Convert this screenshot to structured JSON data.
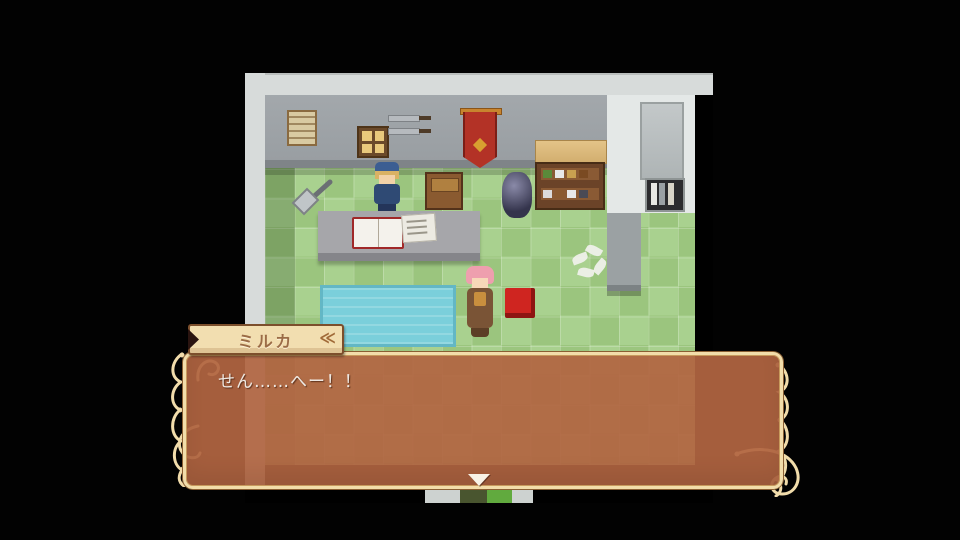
{
  "dialogue": {
    "speaker": "ミルカ",
    "text": "せん……へー！！",
    "banner_chevron": "≪",
    "colors": {
      "box_fill": "rgba(178,101,66,0.93)",
      "box_border": "#f2ddaa",
      "banner_fill": "#f2deb0",
      "banner_border": "#7c4f2c",
      "banner_text": "#9b6c46",
      "dialogue_text": "#eee8e2",
      "ornament": "#f1dcab"
    }
  },
  "game": {
    "viewport": {
      "x": 245,
      "y": 73,
      "width": 468,
      "height": 430
    },
    "colors": {
      "letterbox": "#020202",
      "outer_wall": "#d7dbda",
      "inner_wall": "#9aa0a4",
      "wall_baseboard": "#7f8488",
      "floor_light": "#a9d18f",
      "floor_dark": "#9bc57e",
      "water": "#7bcfdb",
      "counter": "#a6a6aa",
      "red_box": "#cf2520",
      "wall_banner_red": "#b33226"
    },
    "objects": [
      {
        "name": "notice-board"
      },
      {
        "name": "wall-window"
      },
      {
        "name": "mounted-swords"
      },
      {
        "name": "red-wall-banner"
      },
      {
        "name": "item-shelf"
      },
      {
        "name": "wall-bookshelf"
      },
      {
        "name": "counter-desk"
      },
      {
        "name": "open-book"
      },
      {
        "name": "papers"
      },
      {
        "name": "shovel"
      },
      {
        "name": "supply-crate"
      },
      {
        "name": "armor-statue"
      },
      {
        "name": "shopkeeper-npc"
      },
      {
        "name": "milka-character"
      },
      {
        "name": "red-box"
      },
      {
        "name": "water-pool"
      },
      {
        "name": "flower-petals"
      },
      {
        "name": "south-doorway"
      }
    ]
  }
}
